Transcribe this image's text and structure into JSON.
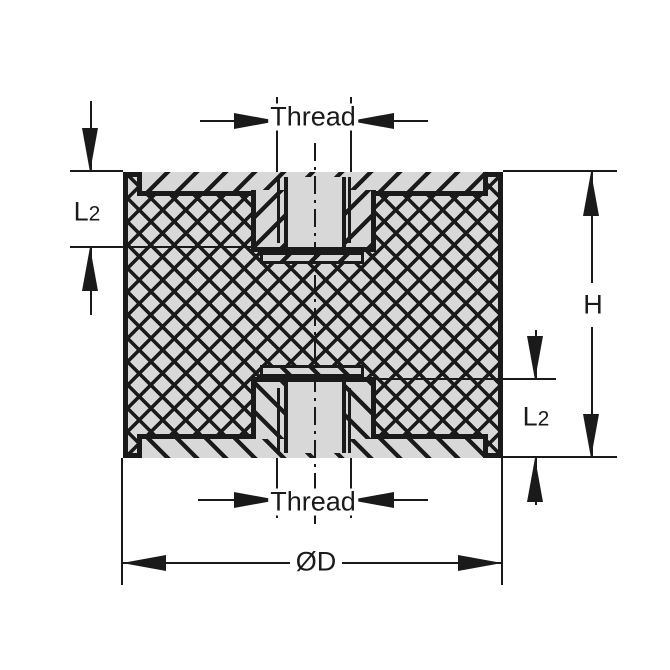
{
  "drawing": {
    "labels": {
      "thread_top": "Thread",
      "thread_bottom": "Thread",
      "l2_main": "L",
      "l2_sub": "2",
      "height": "H",
      "diameter": "ØD"
    },
    "colors": {
      "line": "#1a1a1a",
      "fill": "#d8d8d8",
      "background": "#ffffff"
    }
  }
}
